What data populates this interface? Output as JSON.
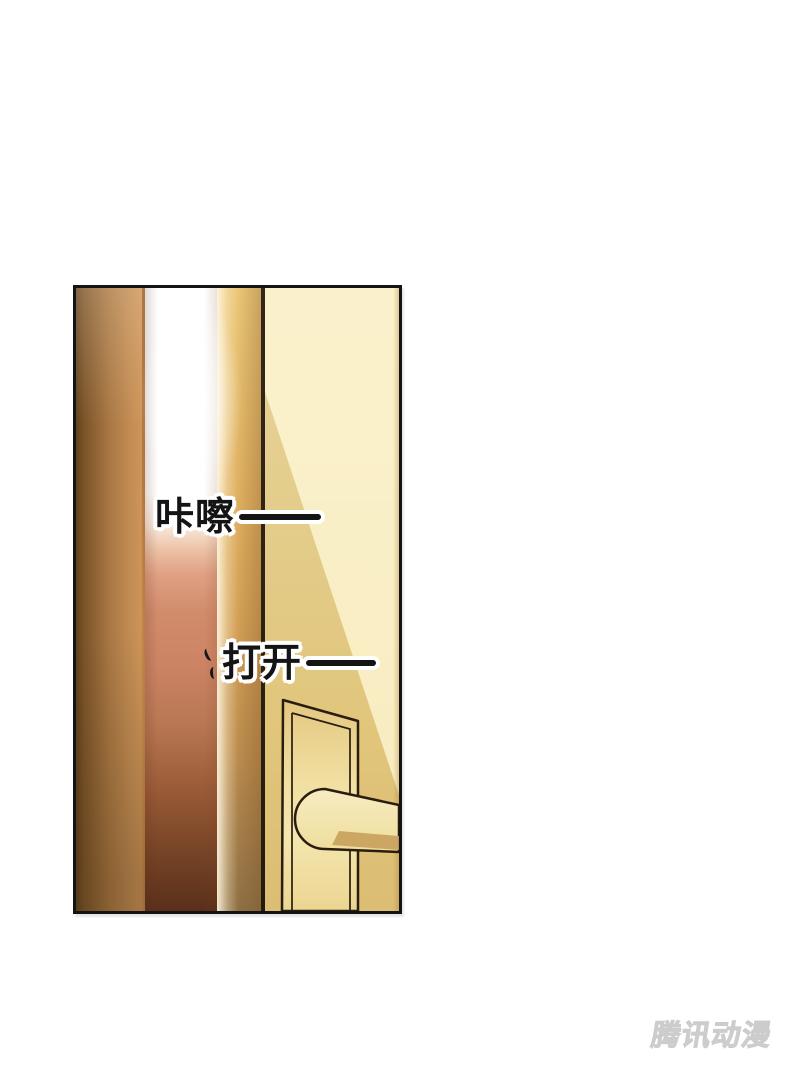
{
  "page": {
    "background_color": "#ffffff"
  },
  "panel": {
    "sfx_bubbles": [
      {
        "text": "咔嚓",
        "dash": "——"
      },
      {
        "text": "打开",
        "dash": "——"
      }
    ],
    "colors": {
      "panel_border": "#141414",
      "frame_brown_dark": "#6b4a26",
      "frame_brown_light": "#c98a52",
      "light_gap_top": "#ffffff",
      "light_gap_mid": "#d18c6a",
      "light_gap_bottom": "#5a2f1a",
      "door_edge_gold": "#d9a85c",
      "door_edge_line": "#2c2014",
      "door_face": "#ecd58f",
      "door_face_highlight": "#f6ecc2",
      "hardware_fill": "#f2e3a8",
      "hardware_outline": "#2a1c0e",
      "handle_underside": "#c8a15c",
      "sfx_text": "#141414",
      "sfx_outline": "#ffffff"
    }
  },
  "watermark": {
    "text": "腾讯动漫",
    "color": "#e0e0e0"
  },
  "css_vars": {
    "--sfx-text": "#141414",
    "--sfx-outline": "#ffffff",
    "--watermark-color": "#e0e0e0",
    "--panel-border": "#141414"
  }
}
